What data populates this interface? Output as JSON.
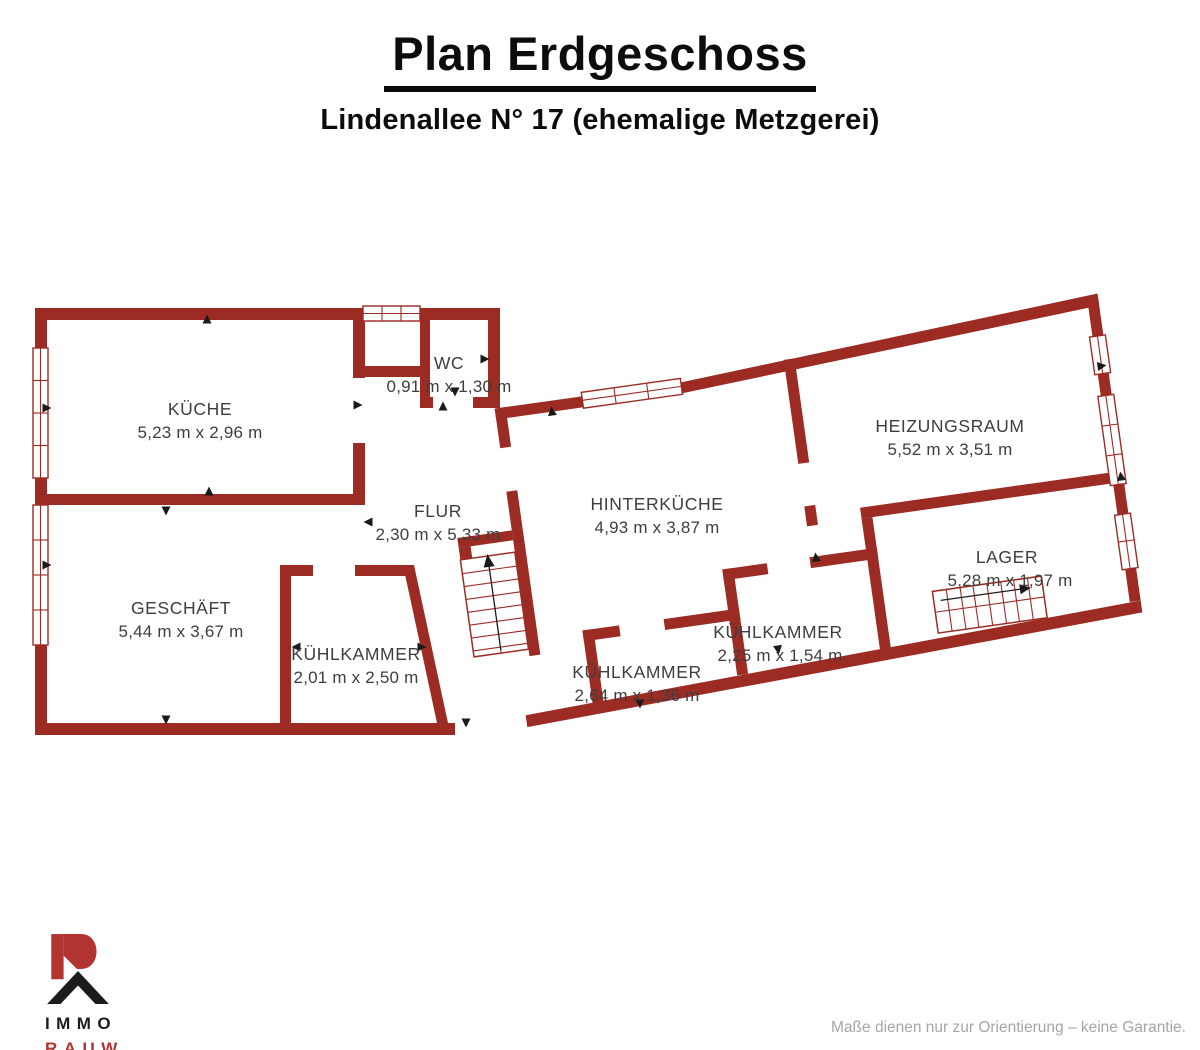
{
  "header": {
    "title": "Plan Erdgeschoss",
    "subtitle": "Lindenallee N° 17 (ehemalige Metzgerei)"
  },
  "rooms": {
    "kueche": {
      "name": "KÜCHE",
      "dims": "5,23 m x 2,96 m"
    },
    "wc": {
      "name": "WC",
      "dims": "0,91 m x 1,30 m"
    },
    "flur": {
      "name": "FLUR",
      "dims": "2,30 m x 5,33 m"
    },
    "geschaeft": {
      "name": "GESCHÄFT",
      "dims": "5,44 m x 3,67 m"
    },
    "kuehlkammer_links": {
      "name": "KÜHLKAMMER",
      "dims": "2,01 m x 2,50 m"
    },
    "hinterkueche": {
      "name": "HINTERKÜCHE",
      "dims": "4,93 m x 3,87 m"
    },
    "heizungsraum": {
      "name": "HEIZUNGSRAUM",
      "dims": "5,52 m x 3,51 m"
    },
    "lager": {
      "name": "LAGER",
      "dims": "5,28 m x 1,97 m"
    },
    "kuehlkammer_mitte": {
      "name": "KÜHLKAMMER",
      "dims": "2,64 m x 1,36 m"
    },
    "kuehlkammer_rechts": {
      "name": "KÜHLKAMMER",
      "dims": "2,25 m x 1,54 m"
    }
  },
  "logo": {
    "line1": "IMMO",
    "line2": "RAUW"
  },
  "footer": {
    "disclaimer": "Maße dienen nur zur Orientierung – keine Garantie."
  },
  "colors": {
    "wall": "#9C2B24",
    "logo_red": "#B13430",
    "label_text": "#3E3E3E",
    "disclaimer_text": "#A6A6A6"
  }
}
